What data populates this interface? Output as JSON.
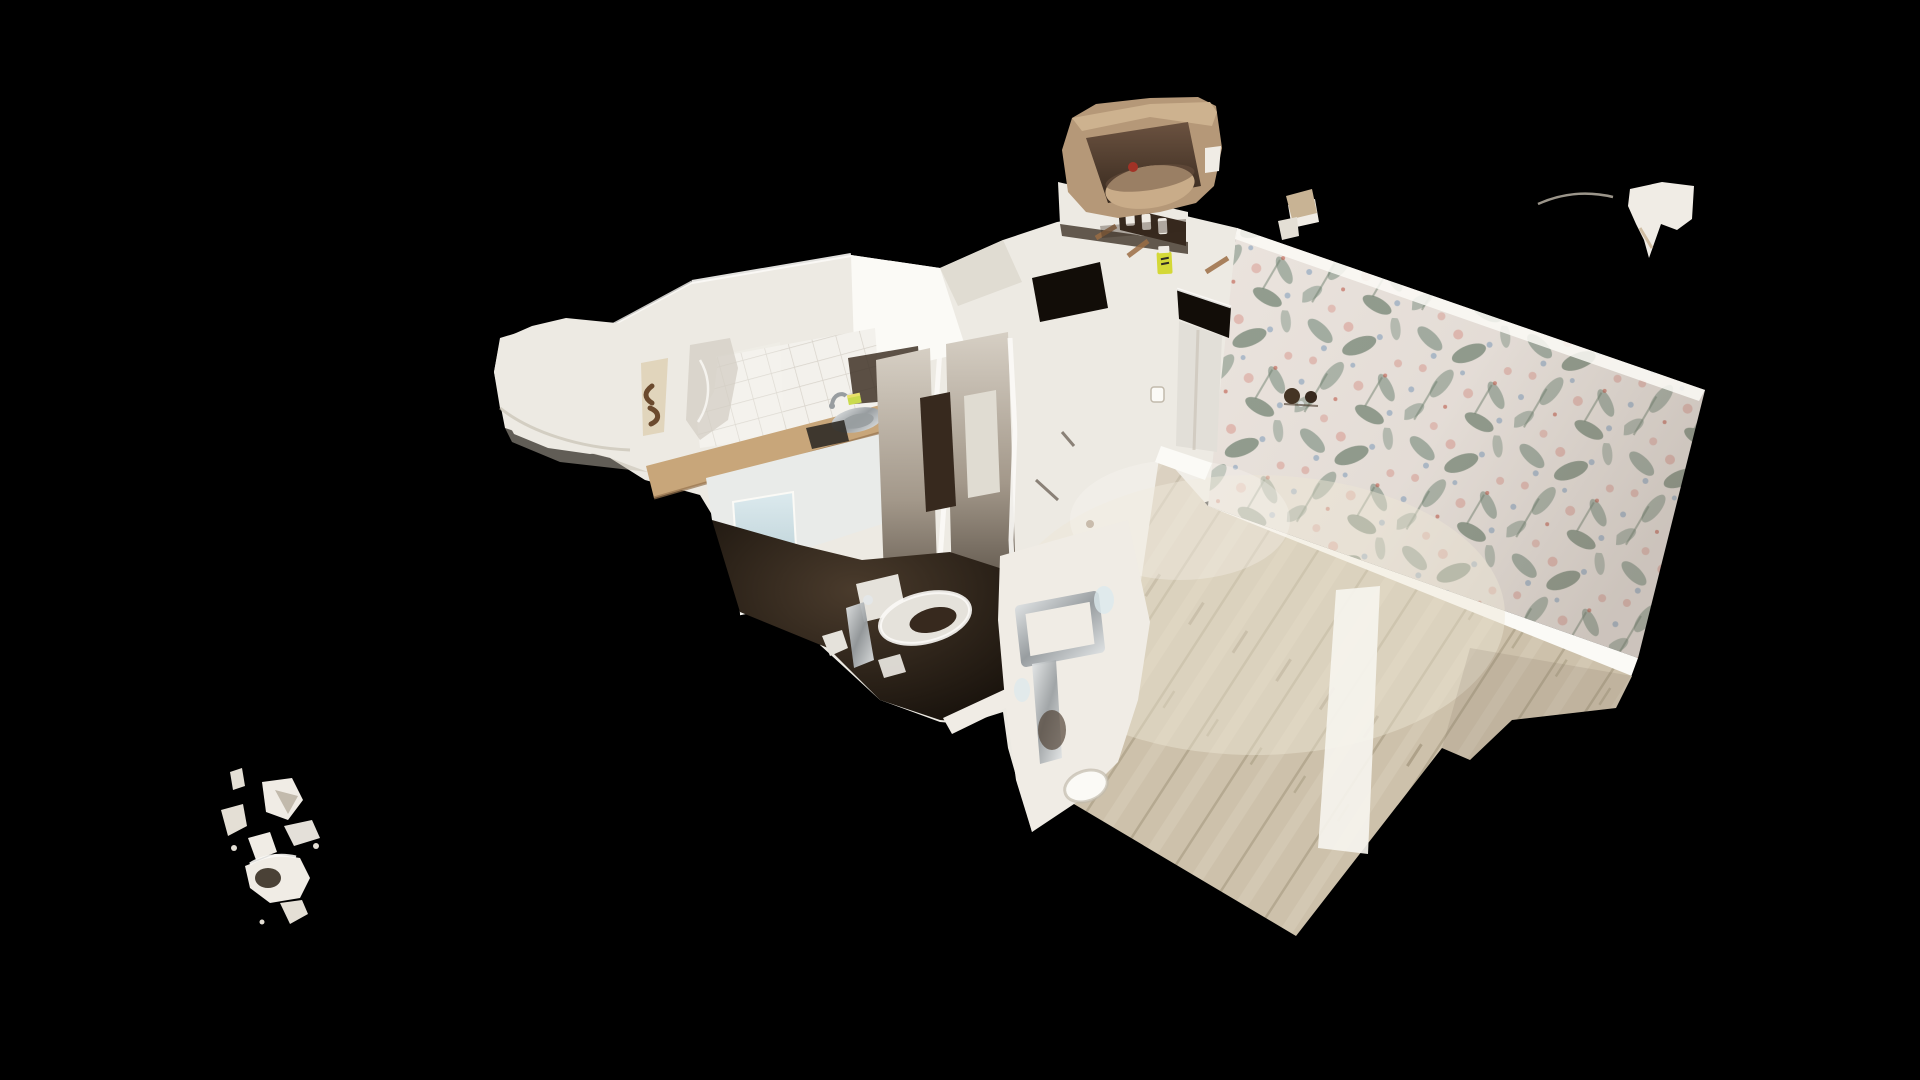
{
  "viewport": {
    "kind": "3d-dollhouse-scan-view",
    "background": "#000000"
  },
  "model": {
    "elements": [
      "kitchen",
      "tile-backsplash",
      "sink",
      "counter",
      "cooktop",
      "mirror-panel",
      "bathroom",
      "toilet",
      "chrome-pipes",
      "left-wall-fragment",
      "torn-wall-panels",
      "front-wall-fragment",
      "doorway",
      "door-panel",
      "light-switch",
      "wallpaper-wall",
      "wall-lamp",
      "wood-floor",
      "floor-light-streak",
      "water-heater-fragment",
      "shelf",
      "spray-bottle",
      "floating-fragment-top-right",
      "debris-cluster-bottom-left"
    ],
    "colors": {
      "background": "#000000",
      "wall_white": "#edeae3",
      "wall_bright": "#fbfaf6",
      "wall_mid": "#e0dcd2",
      "wall_shadow": "#c2baac",
      "tan_strip": "#d9c6a2",
      "melted_gray": "#d2ccc2",
      "tile_base": "#f3f1ec",
      "tile_line": "#d8d3cb",
      "shadow_brown": "#3f3327",
      "counter_wood": "#c8a67a",
      "counter_edge": "#96744e",
      "cabinet_white": "#e9ebe9",
      "mirror_top": "#dceaee",
      "mirror_bottom": "#a9c2c9",
      "chrome_hi": "#e4e7e8",
      "chrome_lo": "#989da0",
      "sponge_green": "#cadb4e",
      "sponge_yellow": "#e8e06a",
      "hob_dark": "#2f2b26",
      "floor_base": "#cdc1ab",
      "floor_line": "#a2957c",
      "floor_grain": "#dcd2bd",
      "floor_knot": "#8f8267",
      "floor_bright": "#eee6d4",
      "streak": "#f6f4ee",
      "wallpaper_base": "#ebe4de",
      "foliage": "#8c9c8f",
      "foliage_dark": "#6d7f6e",
      "blossom_pink": "#dfada4",
      "blossom_blue": "#9fb1c7",
      "berry_red": "#c05a4a",
      "shade_warm": "#6e6154",
      "dark_hi": "#4a3b2c",
      "dark_lo": "#120d08",
      "panel_top": "#d6cfc4",
      "panel_mid": "#a3988a",
      "panel_bottom": "#2b231b",
      "fixture": "#e5e2db",
      "door": "#e2dfd8",
      "heater_shell": "#b59878",
      "heater_rim": "#cdb28f",
      "heater_in_hi": "#6b5240",
      "heater_in_lo": "#37291e",
      "heater_drum": "#c9ac89",
      "red_dot": "#a23226",
      "bottle_yellow": "#d4d837",
      "lamp_dark": "#443424",
      "tan_bit": "#c8b394",
      "wood_beam": "#9b6d44",
      "mark_brown": "#6b4a2e",
      "artifact_gray": "#8a8177",
      "debris_light": "#f0ece5",
      "debris_mid": "#e4dfd5",
      "debris_dark": "#4a4136"
    }
  }
}
